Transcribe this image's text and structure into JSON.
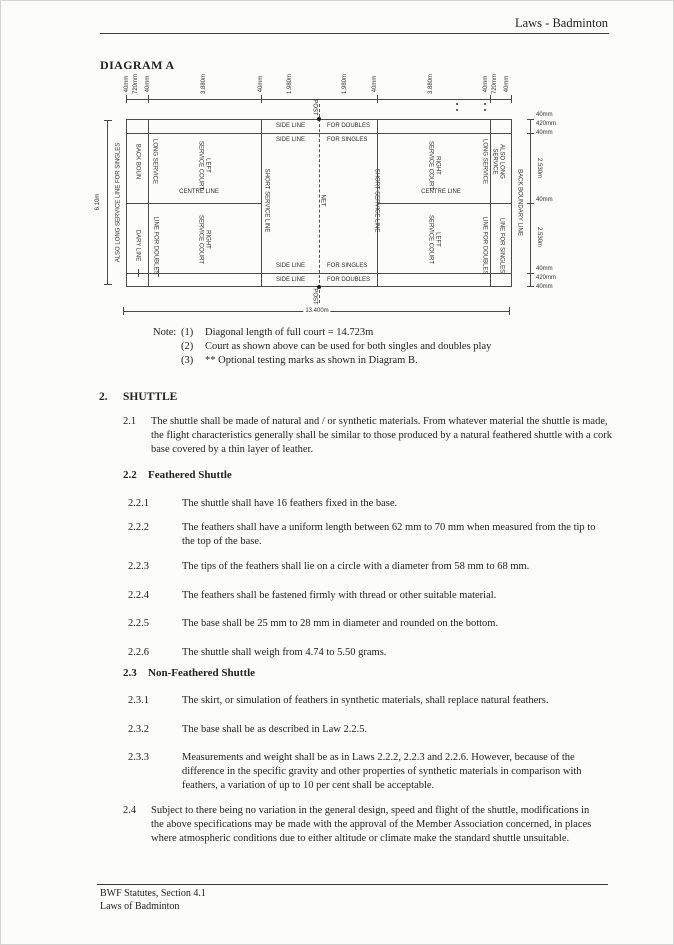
{
  "page": {
    "header_title": "Laws - Badminton",
    "footer_line1": "BWF Statutes, Section 4.1",
    "footer_line2": "Laws of Badminton"
  },
  "diagram": {
    "title": "DIAGRAM A",
    "top_dims": [
      "40mm",
      "720mm",
      "40mm",
      "3.880m",
      "40mm",
      "1.980m",
      "1.980m",
      "40mm",
      "3.880m",
      "40mm",
      "720mm",
      "40mm"
    ],
    "right_dims": [
      "40mm",
      "420mm",
      "40mm",
      "2.530m",
      "40mm",
      "2.530m",
      "40mm",
      "420mm",
      "40mm"
    ],
    "left_dim": "6.10m",
    "bottom_dim": "13.400m",
    "post": "POST",
    "net": "NET",
    "labels": {
      "side_line": "SIDE LINE",
      "for_doubles": "FOR DOUBLES",
      "for_singles": "FOR SINGLES",
      "left_service_court": [
        "LEFT",
        "SERVICE COURT"
      ],
      "right_service_court": [
        "RIGHT",
        "SERVICE COURT"
      ],
      "centre_line": "CENTRE LINE",
      "short_service_line": "SHORT SERVICE LINE",
      "long_service": "LONG SERVICE",
      "line_for_doubles": "LINE FOR DOUBLES",
      "back_boun": "BACK BOUN",
      "dary_line": "DARY LINE",
      "also_long_service": "ALSO LONG SERVICE",
      "line_for_singles": "LINE FOR SINGLES",
      "also_long_full": "ALSO LONG SERVICE LINE FOR SINGLES",
      "back_boundary_full": "BACK BOUNDARY LINE"
    }
  },
  "note": {
    "label": "Note:",
    "items": [
      {
        "num": "(1)",
        "text": "Diagonal length of full court = 14.723m"
      },
      {
        "num": "(2)",
        "text": "Court as shown above can be used for both singles and doubles play"
      },
      {
        "num": "(3)",
        "text": "** Optional testing marks as shown in Diagram B."
      }
    ]
  },
  "section": {
    "number": "2.",
    "title": "SHUTTLE",
    "law_2_1": {
      "num": "2.1",
      "text": "The shuttle shall be made of natural and / or synthetic materials. From whatever material the shuttle is made, the flight characteristics generally shall be similar to those produced by a natural feathered shuttle with a cork base covered by a thin layer of leather."
    },
    "sub_2_2": {
      "num": "2.2",
      "title": "Feathered Shuttle"
    },
    "laws_2_2": [
      {
        "num": "2.2.1",
        "text": "The shuttle shall have 16 feathers fixed in the base."
      },
      {
        "num": "2.2.2",
        "text": "The feathers shall have a uniform length between 62 mm to 70 mm when measured from the tip to the top of the base."
      },
      {
        "num": "2.2.3",
        "text": "The tips of the feathers shall lie on a circle with a diameter from 58 mm to 68 mm."
      },
      {
        "num": "2.2.4",
        "text": "The feathers shall be fastened firmly with thread or other suitable material."
      },
      {
        "num": "2.2.5",
        "text": "The base shall be 25 mm to 28 mm in diameter and rounded on the bottom."
      },
      {
        "num": "2.2.6",
        "text": "The shuttle shall weigh from 4.74 to 5.50 grams."
      }
    ],
    "sub_2_3": {
      "num": "2.3",
      "title": "Non-Feathered Shuttle"
    },
    "laws_2_3": [
      {
        "num": "2.3.1",
        "text": "The skirt, or simulation of feathers in synthetic materials, shall replace natural feathers."
      },
      {
        "num": "2.3.2",
        "text": "The base shall be as described in Law 2.2.5."
      },
      {
        "num": "2.3.3",
        "text": "Measurements and weight shall be as in Laws 2.2.2, 2.2.3 and 2.2.6. However, because of the difference in the specific gravity and other properties of synthetic materials in comparison with feathers, a variation of up to 10 per cent shall be acceptable."
      }
    ],
    "law_2_4": {
      "num": "2.4",
      "text": "Subject to there being no variation in the general design, speed and flight of the shuttle, modifications in the above specifications may be made with the approval of the Member Association concerned, in places where atmospheric conditions due to either altitude or climate make the standard shuttle unsuitable."
    }
  }
}
